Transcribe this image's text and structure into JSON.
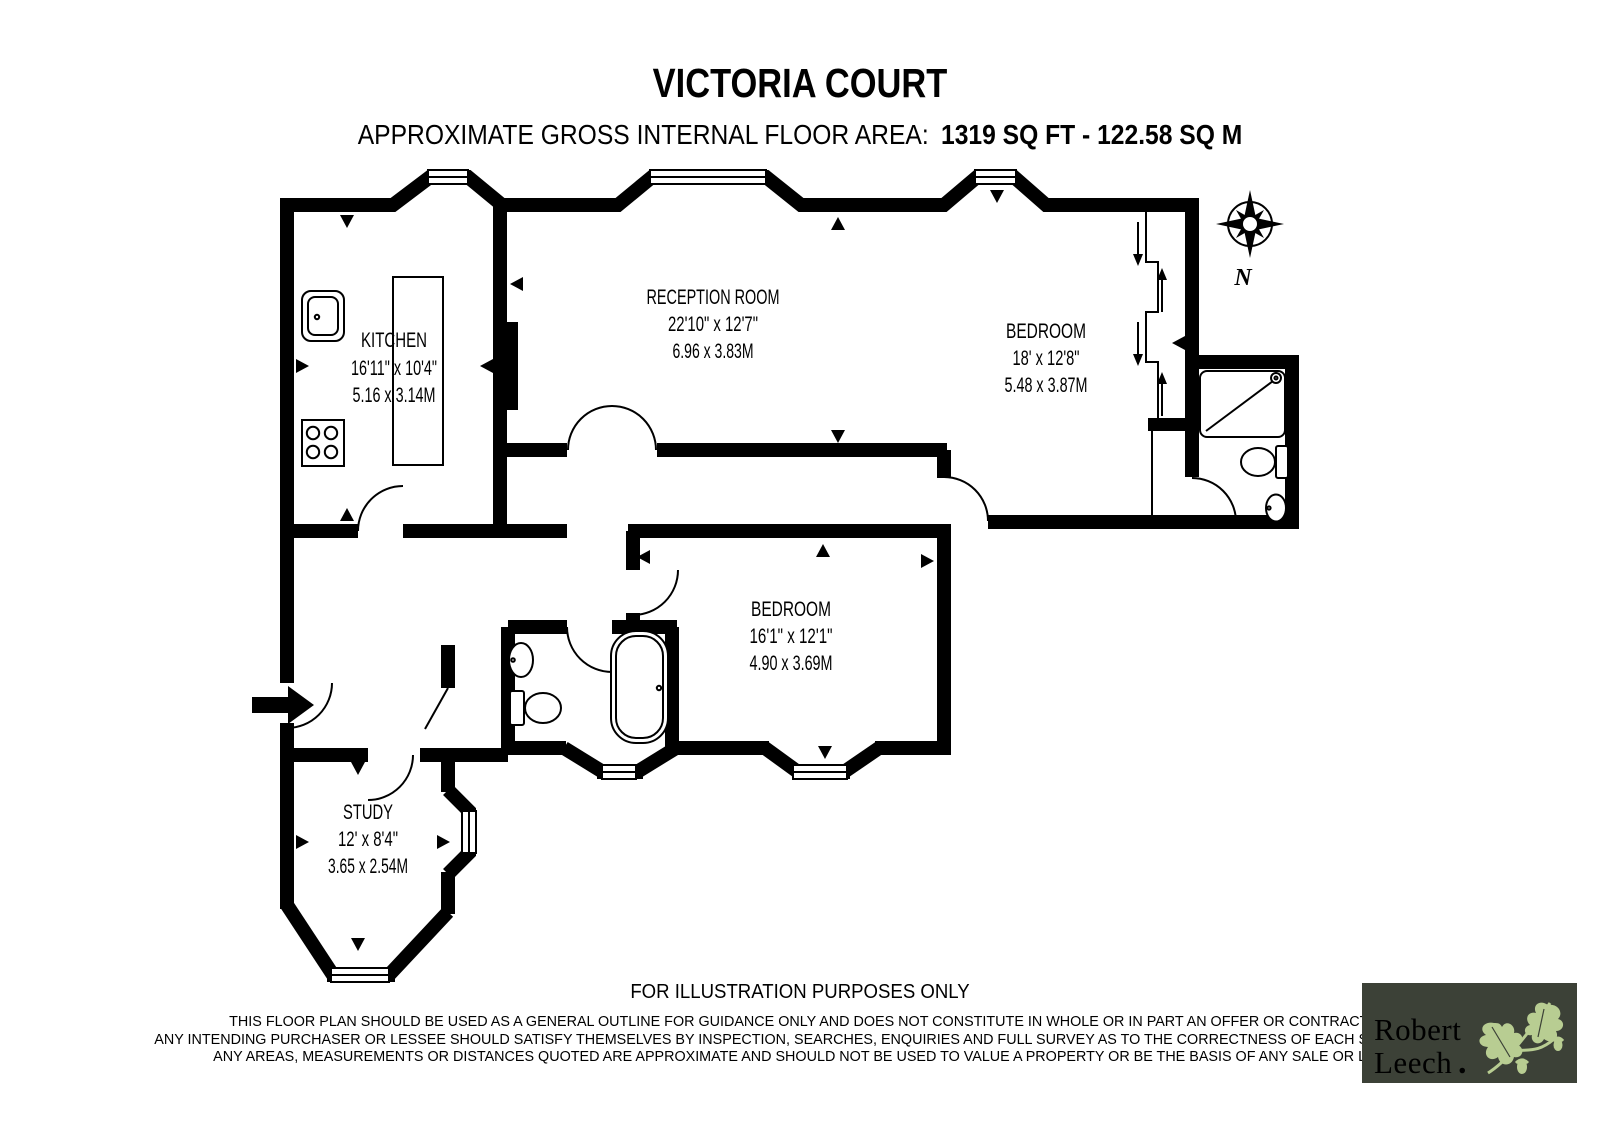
{
  "header": {
    "title": "VICTORIA COURT",
    "area_label": "APPROXIMATE GROSS INTERNAL FLOOR AREA:",
    "area_value": "1319 SQ FT  -  122.58 SQ M"
  },
  "compass": {
    "label": "N"
  },
  "rooms": {
    "kitchen": {
      "name": "KITCHEN",
      "imperial": "16'11\" x 10'4\"",
      "metric": "5.16 x 3.14M"
    },
    "reception": {
      "name": "RECEPTION ROOM",
      "imperial": "22'10\" x 12'7\"",
      "metric": "6.96 x 3.83M"
    },
    "bedroom1": {
      "name": "BEDROOM",
      "imperial": "18' x 12'8\"",
      "metric": "5.48 x 3.87M"
    },
    "bedroom2": {
      "name": "BEDROOM",
      "imperial": "16'1\" x 12'1\"",
      "metric": "4.90 x 3.69M"
    },
    "study": {
      "name": "STUDY",
      "imperial": "12' x 8'4\"",
      "metric": "3.65 x 2.54M"
    }
  },
  "footer": {
    "illustration_note": "FOR ILLUSTRATION PURPOSES ONLY",
    "disclaimer_lines": [
      "THIS FLOOR PLAN SHOULD BE USED AS A GENERAL OUTLINE FOR GUIDANCE ONLY AND DOES NOT CONSTITUTE IN WHOLE OR IN PART AN OFFER OR CONTRACT.",
      "ANY INTENDING PURCHASER OR LESSEE SHOULD SATISFY THEMSELVES BY INSPECTION, SEARCHES, ENQUIRIES AND FULL SURVEY AS TO THE CORRECTNESS OF EACH STATEMENT.",
      "ANY AREAS, MEASUREMENTS OR DISTANCES QUOTED ARE APPROXIMATE AND SHOULD NOT BE USED TO VALUE A PROPERTY OR BE THE BASIS OF ANY SALE OR LET."
    ]
  },
  "logo": {
    "name_line1": "Robert",
    "name_line2": "Leech",
    "dot": "."
  },
  "colors": {
    "wall": "#000000",
    "logo_bg": "#3c4137",
    "logo_leaf": "#b8cd92",
    "logo_dot": "#e8174f"
  }
}
